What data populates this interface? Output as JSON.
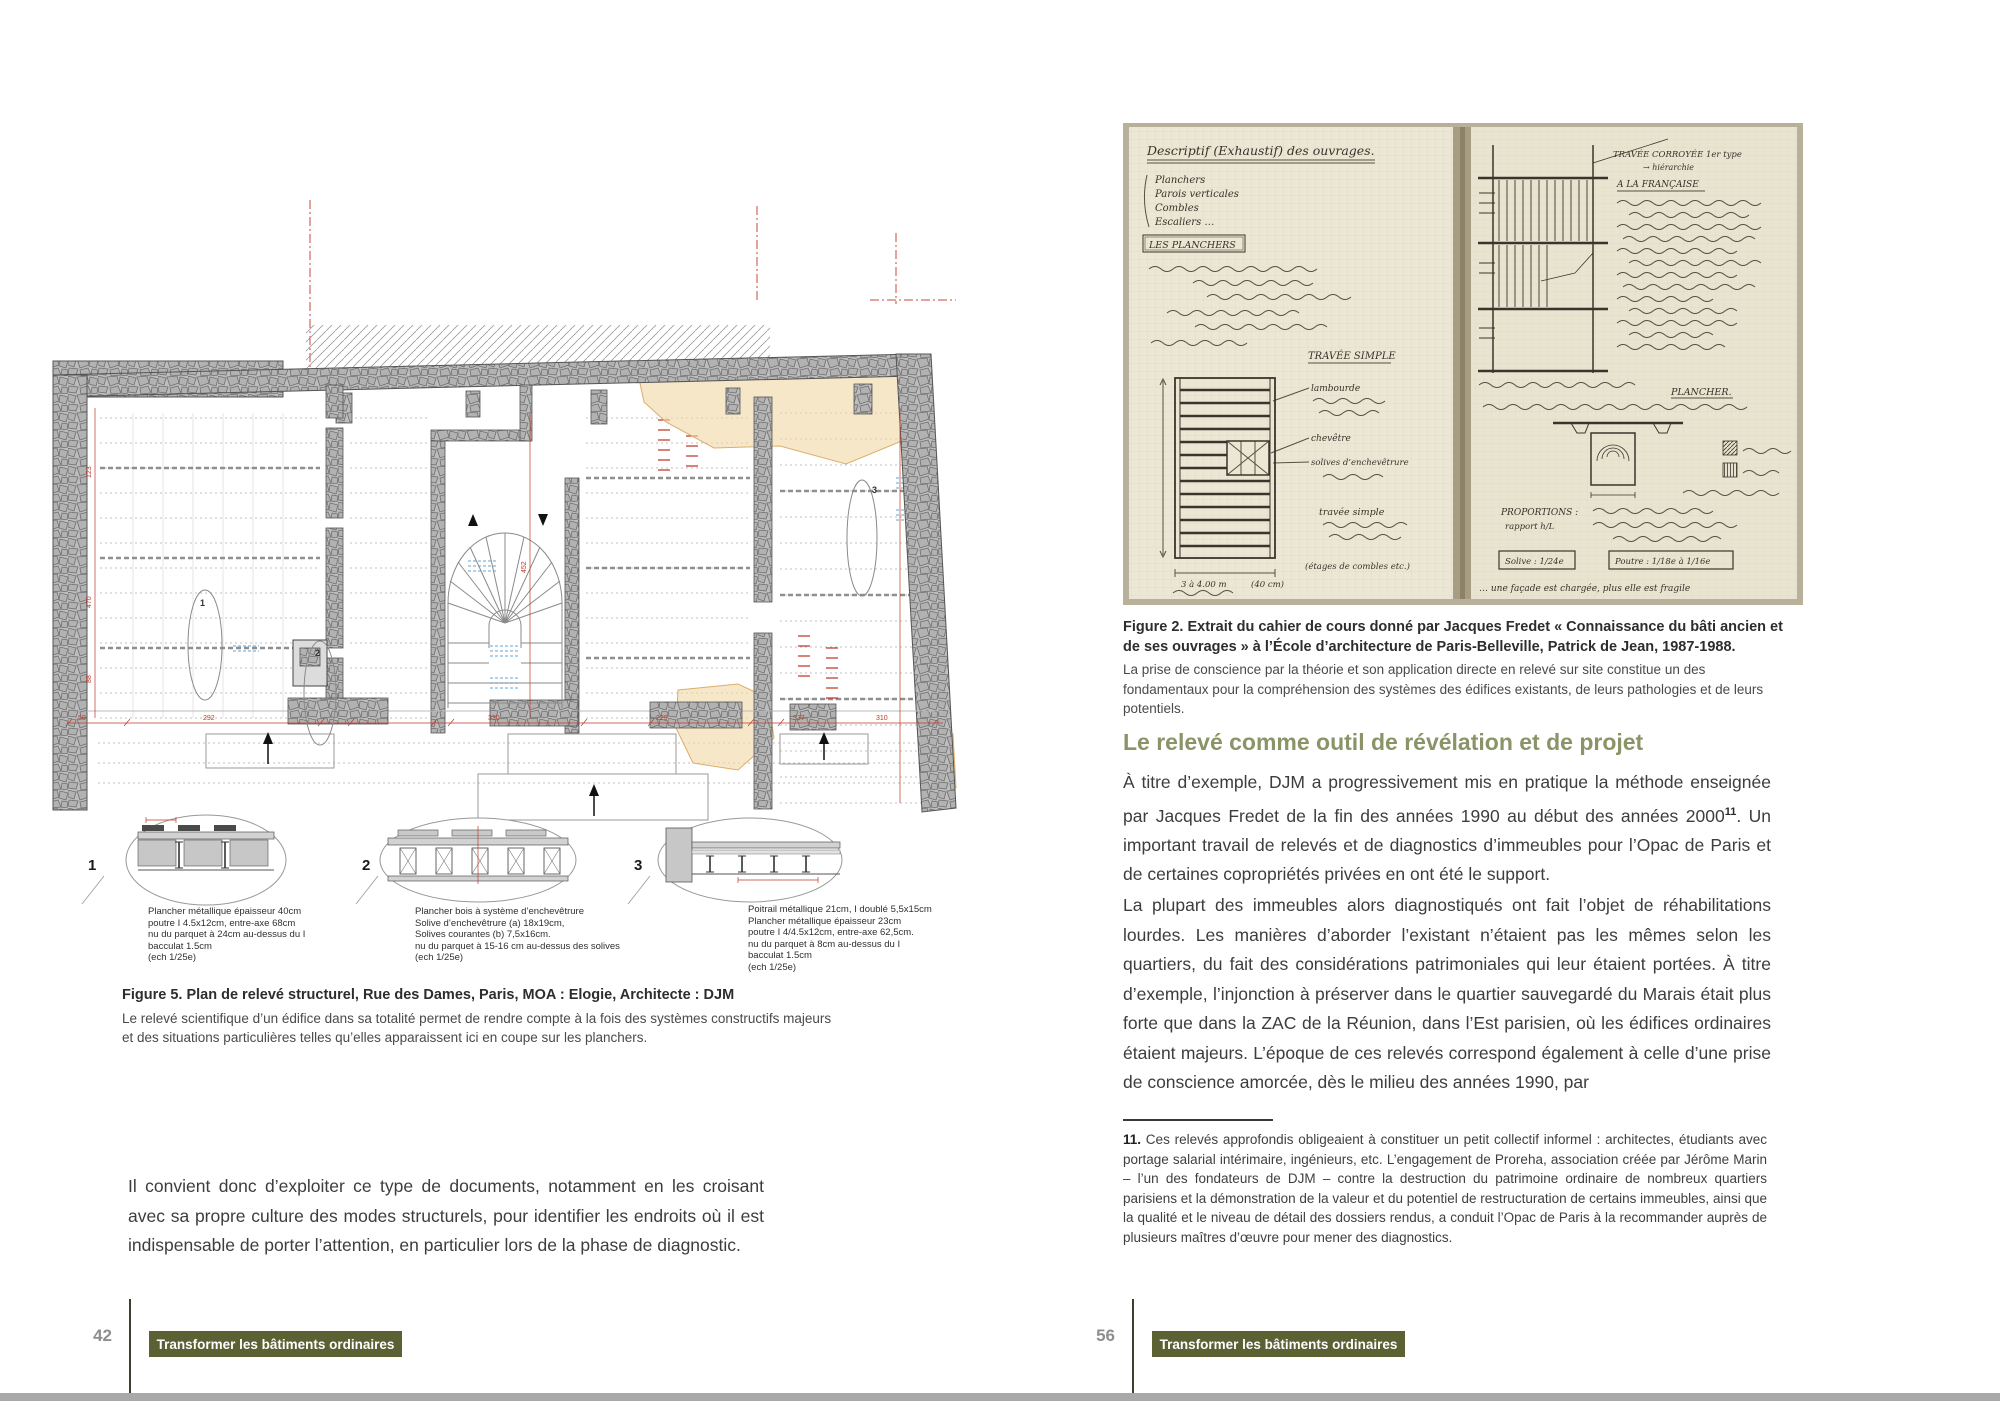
{
  "document": {
    "kind": "book-spread",
    "language": "fr"
  },
  "colors": {
    "heading_green": "#8a9467",
    "badge_background": "#5c6134",
    "footer_rule": "#3f402c",
    "page_number_gray": "#8e8e8e",
    "bottom_bar_gray": "#a9a9a9",
    "plan_dimension_red": "#c0392b",
    "plan_patch_orange": "#f2d9a8",
    "plan_marks_blue": "#85b4d9",
    "notebook_paper": "#ece7d4"
  },
  "left_page": {
    "page_number": "42",
    "footer_badge": "Transformer les bâtiments ordinaires",
    "figure5": {
      "caption_title": "Figure 5. Plan de relevé structurel, Rue des Dames, Paris, MOA : Elogie, Architecte : DJM",
      "caption_body": "Le relevé scientifique d’un édifice dans sa totalité permet de rendre compte à la fois des systèmes constructifs majeurs et des situations particulières telles qu’elles apparaissent ici en coupe sur les planchers.",
      "plan_dims": {
        "d1": "292",
        "d2": "330",
        "d3": "229",
        "d4": "337",
        "d5": "310",
        "d6": "50",
        "v1": "123",
        "v2": "470",
        "v3": "88",
        "v4": "452"
      },
      "section_numbers": [
        "1",
        "2",
        "3"
      ],
      "details": [
        {
          "num": "1",
          "lines": [
            "Plancher métallique épaisseur 40cm",
            "poutre I 4.5x12cm, entre-axe 68cm",
            "nu du parquet à 24cm au-dessus du I",
            "bacculat 1.5cm",
            "(ech 1/25e)"
          ]
        },
        {
          "num": "2",
          "lines": [
            "Plancher bois à système d’enchevêtrure",
            "Solive d’enchevêtrure (a) 18x19cm,",
            "Solives courantes (b) 7,5x16cm.",
            "nu du parquet à 15-16 cm au-dessus des solives",
            "(ech 1/25e)"
          ]
        },
        {
          "num": "3",
          "lines": [
            "Poitrail métallique 21cm, I doublé 5,5x15cm",
            "Plancher métallique épaisseur 23cm",
            "poutre I 4/4.5x12cm, entre-axe 62,5cm.",
            "nu du parquet à 8cm au-dessus du I",
            "bacculat 1.5cm",
            "(ech 1/25e)"
          ]
        }
      ]
    },
    "body_paragraph": "Il convient donc d’exploiter ce type de documents, notamment en les croisant avec sa propre culture des modes structurels, pour identifier les endroits où il est indispensable de porter l’attention, en particulier lors de la phase de diagnostic."
  },
  "right_page": {
    "page_number": "56",
    "footer_badge": "Transformer les bâtiments ordinaires",
    "figure2": {
      "caption_title": "Figure 2. Extrait du cahier de cours donné par Jacques Fredet « Connaissance du bâti ancien et de ses ouvrages » à l’École d’architecture de Paris-Belleville, Patrick de Jean, 1987-1988.",
      "caption_body": "La prise de conscience par la théorie et son application directe en relevé sur site constitue un des fondamentaux pour la compréhension des systèmes des édifices existants, de leurs pathologies et de leurs potentiels.",
      "notebook": {
        "title": "Descriptif (Exhaustif) des ouvrages.",
        "list": [
          "Planchers",
          "Parois verticales",
          "Combles",
          "Escaliers …"
        ],
        "boxed": "LES PLANCHERS",
        "travee_simple": "TRAVÉE SIMPLE",
        "lambourde": "lambourde",
        "chevetre": "chevêtre",
        "solives": "solives d’enchevêtrure",
        "travee_simple2": "travée simple",
        "etages": "(étages de combles etc.)",
        "dim1": "3 à 4.00 m",
        "dim2": "(40 cm)",
        "travee_corroyee": "TRAVÉE CORROYÉE 1er type",
        "hierarchie": "→ hiérarchie",
        "a_la_francaise": "A LA FRANÇAISE",
        "plancher": "PLANCHER.",
        "proportions": "PROPORTIONS :",
        "rapport": "rapport h/L",
        "solive_ratio": "Solive : 1/24e",
        "poutre_ratio": "Poutre : 1/18e à 1/16e",
        "bottom_line": "… une façade est chargée, plus elle est fragile"
      }
    },
    "section_heading": "Le relevé comme outil de révélation et de projet",
    "para1_before": "À titre d’exemple, DJM a progressivement mis en pratique la méthode enseignée par Jacques Fredet de la fin des années 1990 au début des années 2000",
    "para1_sup": "11",
    "para1_after": ". Un important travail de relevés et de diagnostics d’immeubles pour l’Opac de Paris et de certaines copropriétés privées en ont été le support.",
    "para2": "La plupart des immeubles alors diagnostiqués ont fait l’objet de réhabilitations lourdes. Les manières d’aborder l’existant n’étaient pas les mêmes selon les quartiers, du fait des considérations patrimoniales qui leur étaient portées. À titre d’exemple, l’injonction à préserver dans le quartier sauvegardé du Marais était plus forte que dans la ZAC de la Réunion, dans l’Est parisien, où les édifices ordinaires étaient majeurs. L’époque de ces relevés correspond également à celle d’une prise de conscience amorcée, dès le milieu des années 1990, par",
    "footnote_num": "11.",
    "footnote_text": " Ces relevés approfondis obligeaient à constituer un petit collectif informel : architectes, étudiants avec portage salarial intérimaire, ingénieurs, etc. L’engagement de Proreha, association créée par Jérôme Marin – l’un des fondateurs de DJM – contre la destruction du patrimoine ordinaire de nombreux quartiers parisiens et la démonstration de la valeur et du potentiel de restructuration de certains immeubles, ainsi que la qualité et le niveau de détail des dossiers rendus, a conduit l’Opac de Paris à la recommander auprès de plusieurs maîtres d’œuvre pour mener des diagnostics."
  }
}
